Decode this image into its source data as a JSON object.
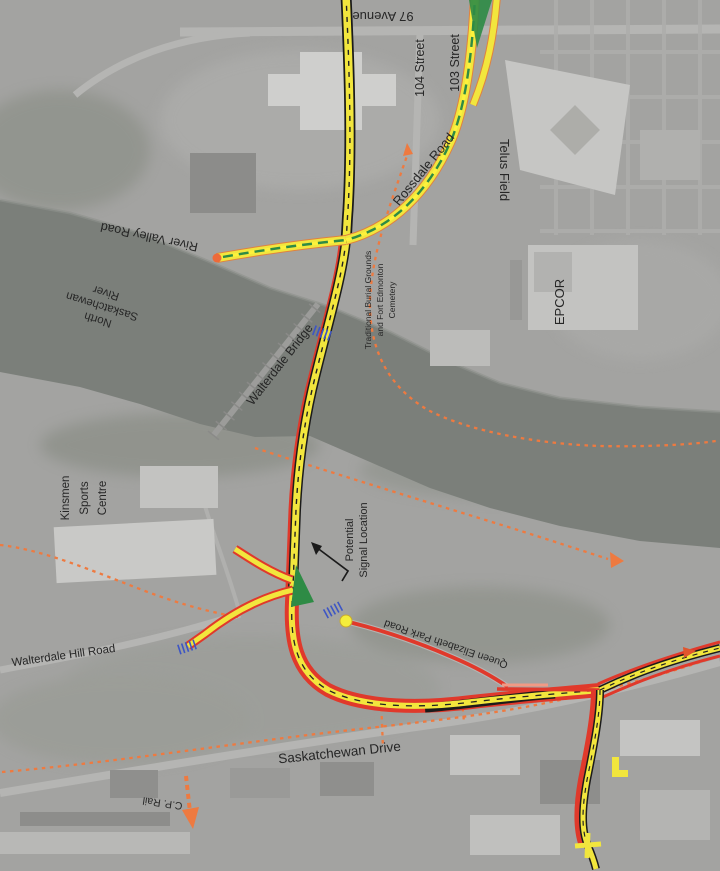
{
  "map": {
    "title": "Walterdale Bridge area concept plan (aerial)",
    "colors": {
      "proposed_road_yellow": "#f2e63d",
      "road_casing_black": "#1b1b1b",
      "alternate_alignment_red": "#e0392b",
      "existing_route_green": "#2e8b45",
      "trail_orange": "#ee7a40",
      "closure_marker_blue": "#3d55c4",
      "river_grey": "#7b7f7a",
      "land_grey": "#a3a3a1",
      "label_text": "#262626"
    },
    "labels": {
      "avenue97": "97 Avenue",
      "street104": "104 Street",
      "street103": "103 Street",
      "rossdale_road": "Rossdale Road",
      "telus_field": "Telus Field",
      "river_valley_road": "River Valley Road",
      "river_line1": "North",
      "river_line2": "Saskatchewan",
      "river_line3": "River",
      "walterdale_bridge": "Walterdale Bridge",
      "cemetery_line1": "Traditional Burial Grounds",
      "cemetery_line2": "and Fort Edmonton",
      "cemetery_line3": "Cemetery",
      "epcor": "EPCOR",
      "kinsmen_line1": "Kinsmen",
      "kinsmen_line2": "Sports",
      "kinsmen_line3": "Centre",
      "signal_line1": "Potential",
      "signal_line2": "Signal Location",
      "qe_park_road": "Queen Elizabeth Park Road",
      "walterdale_hill_road": "Walterdale Hill Road",
      "saskatchewan_drive": "Saskatchewan Drive",
      "cp_rail": "C.P. Rail"
    }
  }
}
